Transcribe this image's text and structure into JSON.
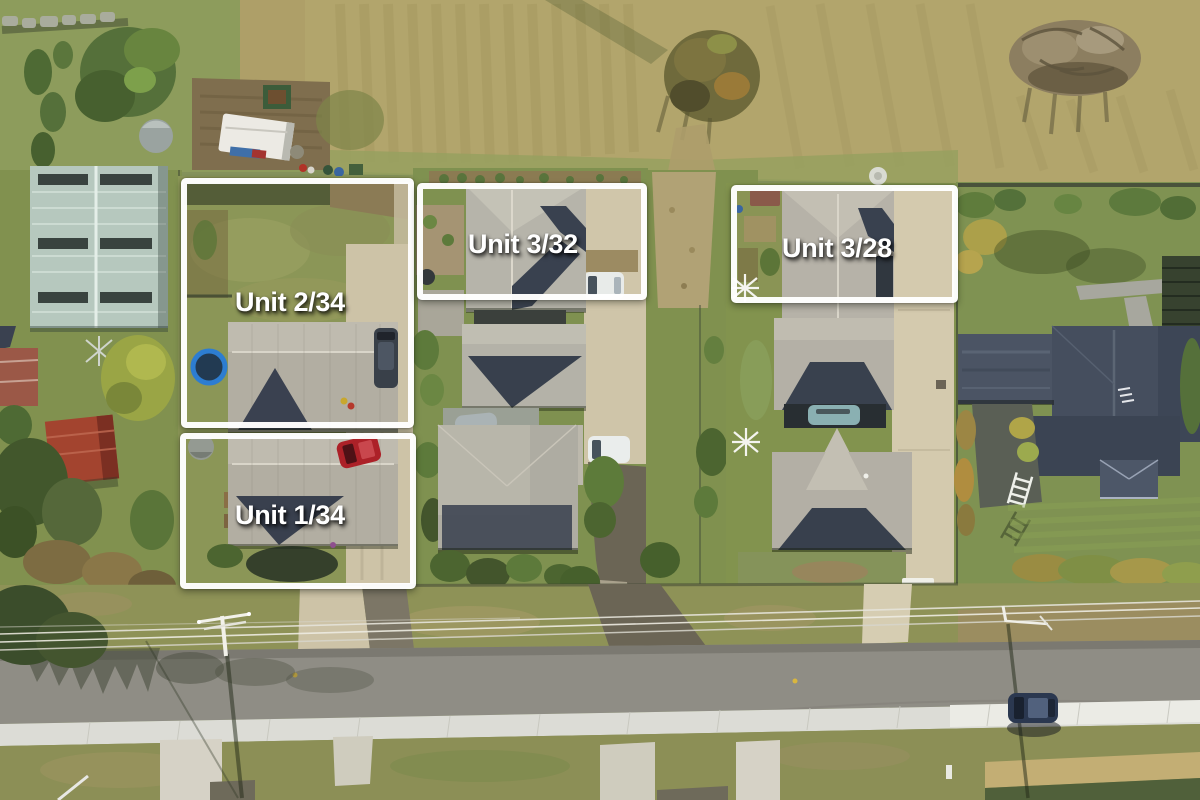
{
  "overlay": {
    "boundary_color": "#ffffff",
    "label_text_color": "#ffffff",
    "units": [
      {
        "id": "unit-2-34",
        "label": "Unit 2/34"
      },
      {
        "id": "unit-1-34",
        "label": "Unit 1/34"
      },
      {
        "id": "unit-3-32",
        "label": "Unit 3/32"
      },
      {
        "id": "unit-3-28",
        "label": "Unit 3/28"
      }
    ]
  }
}
